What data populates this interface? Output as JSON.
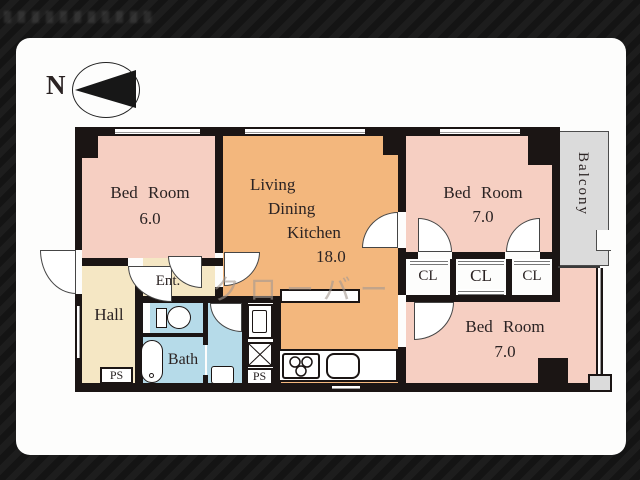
{
  "compass": {
    "north_label": "N"
  },
  "watermark": {
    "center_text": "クローバー"
  },
  "rooms": {
    "bedroom_top_left": {
      "name": "Bed Room",
      "size": "6.0"
    },
    "ldk": {
      "lines": [
        "Living",
        "Dining",
        "Kitchen",
        "18.0"
      ]
    },
    "bedroom_top_right": {
      "name": "Bed Room",
      "size": "7.0"
    },
    "bedroom_bottom_right": {
      "name": "Bed Room",
      "size": "7.0"
    },
    "balcony": {
      "label": "Balcony"
    },
    "hall": {
      "label": "Hall"
    },
    "entrance": {
      "label": "Ent."
    },
    "bath": {
      "label": "Bath"
    },
    "closets": [
      "CL",
      "CL",
      "CL"
    ],
    "pipe_spaces": {
      "left": "PS",
      "center": "PS"
    }
  },
  "colors": {
    "background": "#181818",
    "wall": "#1b1514",
    "bedroom_pink": "#f6cfc2",
    "ldk_orange": "#f3b77d",
    "hall_cream": "#f5e7c4",
    "bath_blue": "#b6dbe9",
    "balcony_gray": "#dbdbdb",
    "watermark_gray": "#a59a92"
  }
}
